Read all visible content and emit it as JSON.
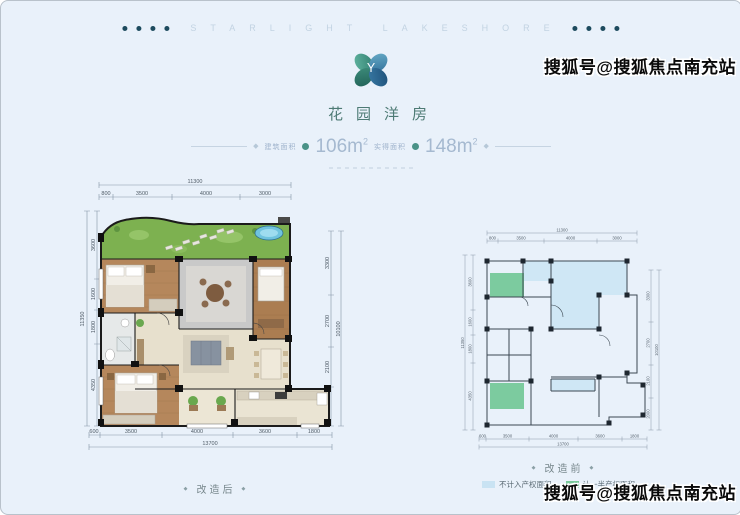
{
  "header": {
    "letters": "STARLIGHT LAKESHORE",
    "dot_color": "#1d4b5e"
  },
  "logo": {
    "letter": "Y",
    "teal": "#3e8f7f",
    "blue": "#2f6e99"
  },
  "title": "花园洋房",
  "area": {
    "label1": "建筑面积",
    "value1": "106m",
    "sup1": "2",
    "label2": "实得面积",
    "value2": "148m",
    "sup2": "2",
    "accent": "#4a9287"
  },
  "dims": {
    "top_total": "11300",
    "top": [
      "800",
      "3500",
      "4000",
      "3000"
    ],
    "left_total": "11350",
    "left": [
      "3600",
      "1600",
      "1800",
      "4350"
    ],
    "right_total": "10100",
    "right": [
      "3300",
      "2700",
      "2100",
      "2000"
    ],
    "bottom_total": "13700",
    "bottom": [
      "600",
      "3500",
      "4000",
      "3600",
      "1800"
    ]
  },
  "plans": {
    "after_label": "改造后",
    "before_label": "改造前",
    "bullet": "◆"
  },
  "legend": {
    "items": [
      {
        "label": "不计入产权面积",
        "color": "#c9e3f3"
      },
      {
        "label": "计一半产权面积",
        "color": "#79c99c"
      }
    ]
  },
  "watermark": {
    "text": "搜狐号@搜狐焦点南充站"
  }
}
